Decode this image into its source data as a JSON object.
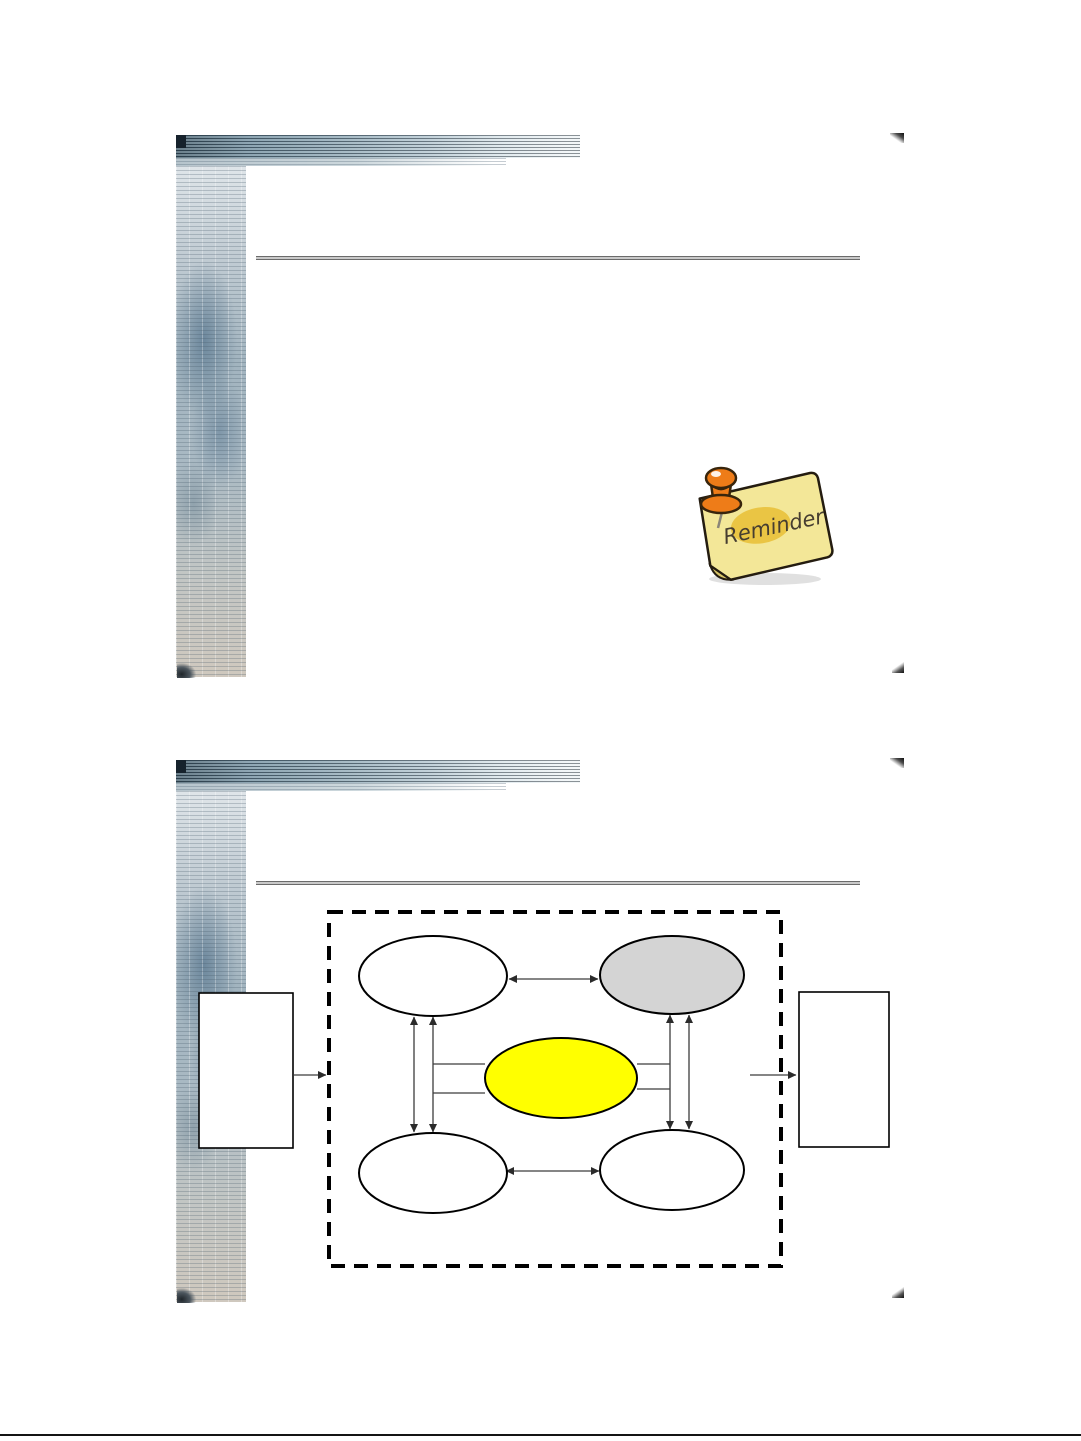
{
  "page": {
    "background": "#ffffff",
    "bottom_rule_color": "#141414"
  },
  "slide1": {
    "reminder": {
      "label": "Reminder",
      "note_fill": "#f3e798",
      "note_underside_fill": "#d8c568",
      "blob_fill": "#e7bd2f",
      "pin_fill": "#ee7c18",
      "pin_outline": "#38250c",
      "text_color": "#463d30"
    }
  },
  "slide2": {
    "diagram": {
      "container_border_color": "#000000",
      "arrow_color": "#3c3c3c",
      "nodes": {
        "left_rectangle": {
          "fill": "#ffffff"
        },
        "right_rectangle": {
          "fill": "#ffffff"
        },
        "ellipse_top_left": {
          "fill": "#ffffff"
        },
        "ellipse_top_right": {
          "fill": "#d4d4d4"
        },
        "ellipse_center": {
          "fill": "#ffff00"
        },
        "ellipse_bottom_left": {
          "fill": "#ffffff"
        },
        "ellipse_bottom_right": {
          "fill": "#ffffff"
        }
      }
    }
  }
}
